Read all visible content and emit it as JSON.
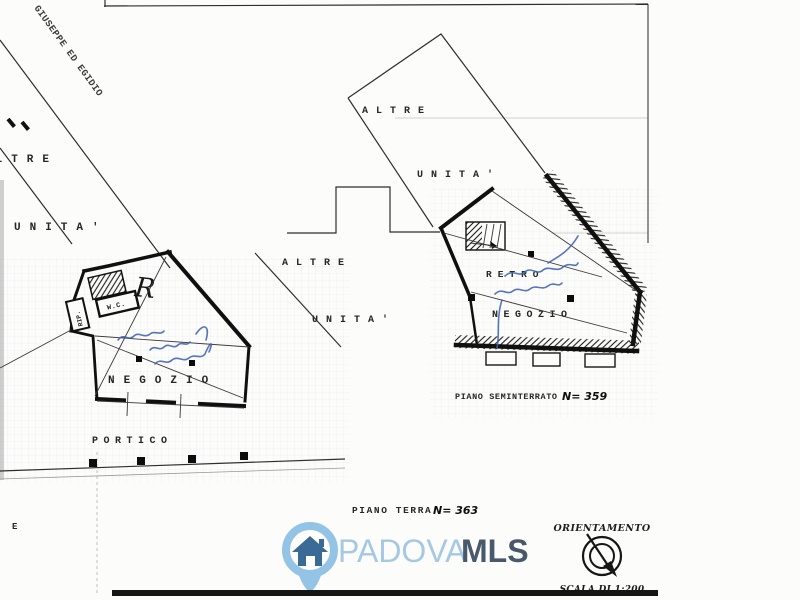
{
  "plan": {
    "street_label": "GIUSEPPE ED EGIDIO",
    "left_parcel": {
      "unit_line1": "ALTRE",
      "unit_line2": "UNITA'",
      "negozio_label": "NEGOZIO",
      "portico_label": "PORTICO",
      "wc_label": "W.C.",
      "rip_label": "RIP.",
      "handwritten_letter": "R"
    },
    "middle_parcel": {
      "unit_line1": "ALTRE",
      "unit_line2": "UNITA'"
    },
    "right_parcel": {
      "unit_line1": "ALTRE",
      "unit_line2": "UNITA'",
      "retro_label": "RETRO",
      "negozio_label": "NEGOZIO"
    },
    "floor_captions": {
      "seminterrato_label": "PIANO SEMINTERRATO",
      "seminterrato_number": "N= 359",
      "terra_label": "PIANO TERRA",
      "terra_number": "N= 363"
    },
    "stray_letter": "E"
  },
  "watermark": {
    "brand_light": "PADOVA",
    "brand_bold": "MLS",
    "pin_color": "#93c4e6",
    "house_color": "#3a6a96",
    "text_light_color": "#a5c9e5",
    "text_bold_color": "#49586a"
  },
  "legend": {
    "orientation_title": "ORIENTAMENTO",
    "scale_label": "SCALA DI 1:200"
  }
}
